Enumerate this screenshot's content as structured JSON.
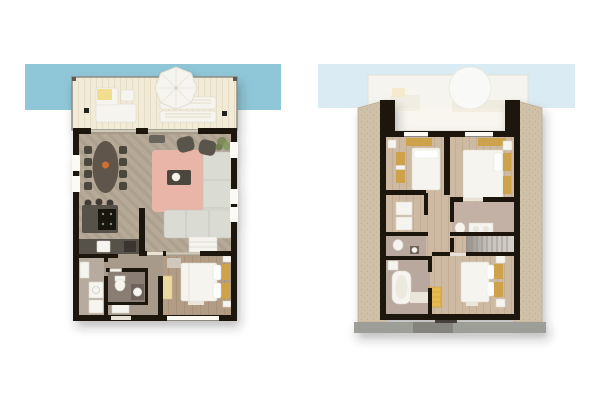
{
  "canvas": {
    "width": 600,
    "height": 400,
    "background": "#ffffff"
  },
  "scene": {
    "kind": "architectural-floor-plans",
    "description": "Two top-down 3D rendered floor plans of a two-storey holiday home, lower floor on the left, upper floor under a pitched roof on the right, each with a waterfront terrace strip at the top",
    "text_visible": false
  },
  "palette": {
    "water_left": "#90c7d8",
    "water_right": "#dbebf3",
    "deck": "#f2ebd7",
    "deck_stripe": "#e5ddc6",
    "deck_border": "#8d8d84",
    "ghost_deck": "#f8f6ee",
    "wall": "#1d1711",
    "window_white": "#fbfaf5",
    "glass": "#cfc9b8",
    "threshold": "#e7e2d5",
    "floor_living": "#b6a998",
    "floor_living_stripe": "#aca08e",
    "floor_bedroom": "#b29c85",
    "floor_bedroom_stripe": "#a79179",
    "floor_hall": "#a89a8b",
    "floor_bath": "#8a7d73",
    "floor_utility": "#b7aa9e",
    "floor_upper": "#cebaa2",
    "floor_upper_stripe": "#c2ae95",
    "floor_upper_bath": "#b9a89e",
    "roof": "#cfc0a8",
    "roof_dot": "#c0b095",
    "roof_edge": "#bdae94",
    "gutter": "#9e9e99",
    "gutter_dark": "#84837d",
    "chimney_dark": "#45413a",
    "rug": "#e9b5a9",
    "sofa": "#dadcd4",
    "furniture_dark": "#4c463e",
    "table_wood": "#5f554b",
    "counter_dark": "#56514a",
    "cooktop": "#16130f",
    "fixture_white": "#f6f4ee",
    "accent_mustard": "#cda24c",
    "accent_yellow_bright": "#e6ba4f",
    "accent_yellow_pale": "#ecd9a0",
    "cushion_yellow": "#f2dc8e",
    "plant_green": "#7e8e5c",
    "decor_orange": "#cf6f2e",
    "stair_tread": "#c7c3bc",
    "stair_line": "#8f8b85"
  },
  "plans": [
    {
      "id": "left-floor-plan",
      "level": "ground-floor",
      "position": "left",
      "outdoor": {
        "water_strip": true,
        "terrace": {
          "furniture": [
            "outdoor-lounge-sofa",
            "yellow-cushion",
            "side-table",
            "parasol",
            "sun-loungers",
            "corner-posts",
            "lanterns"
          ]
        }
      },
      "rooms": [
        {
          "name": "living-room",
          "furniture": [
            "sectional-sofa",
            "pink-rug",
            "coffee-table",
            "armchair",
            "armchair",
            "plant",
            "sideboard",
            "doormat"
          ]
        },
        {
          "name": "dining-area",
          "furniture": [
            "oval-dining-table",
            "dining-chairs-x8",
            "orange-centerpiece"
          ]
        },
        {
          "name": "kitchen",
          "furniture": [
            "island",
            "cooktop",
            "bar-stools-x3",
            "counter-run",
            "sink",
            "appliance"
          ]
        },
        {
          "name": "hallway",
          "furniture": [
            "entry-door"
          ]
        },
        {
          "name": "bathroom",
          "furniture": [
            "toilet",
            "vanity-sink"
          ]
        },
        {
          "name": "utility-room",
          "furniture": [
            "washer",
            "dryer",
            "shelving"
          ]
        },
        {
          "name": "bedroom",
          "furniture": [
            "double-bed",
            "mustard-headboard-cushions",
            "nightstands",
            "pale-yellow-cabinet",
            "dresser",
            "bed-mat"
          ]
        }
      ]
    },
    {
      "id": "right-floor-plan",
      "level": "upper-floor",
      "position": "right",
      "outdoor": {
        "water_strip": true,
        "terrace_ghost": {
          "furniture": [
            "parasol-ghost",
            "lounge-ghost"
          ]
        },
        "roof_surround": true,
        "gutter_strip": true
      },
      "rooms": [
        {
          "name": "bedroom-top-left",
          "furniture": [
            "double-bed",
            "mustard-bench",
            "mustard-nightstands",
            "dresser"
          ]
        },
        {
          "name": "bedroom-top-right",
          "furniture": [
            "double-bed",
            "mustard-bench",
            "mustard-headboard-cushions",
            "nightstand"
          ]
        },
        {
          "name": "bedroom-bottom",
          "furniture": [
            "double-bed",
            "mustard-headboard-cushions",
            "nightstands",
            "yellow-dresser",
            "bed-mat"
          ]
        },
        {
          "name": "closet-room",
          "furniture": [
            "wardrobe-boxes"
          ]
        },
        {
          "name": "wc",
          "furniture": [
            "toilet",
            "small-sink"
          ]
        },
        {
          "name": "bathroom-small",
          "furniture": [
            "vanity",
            "toilet"
          ]
        },
        {
          "name": "bathroom-large",
          "furniture": [
            "bathtub",
            "corner-sink",
            "bath-mat"
          ]
        },
        {
          "name": "landing",
          "furniture": [
            "staircase"
          ]
        }
      ]
    }
  ]
}
